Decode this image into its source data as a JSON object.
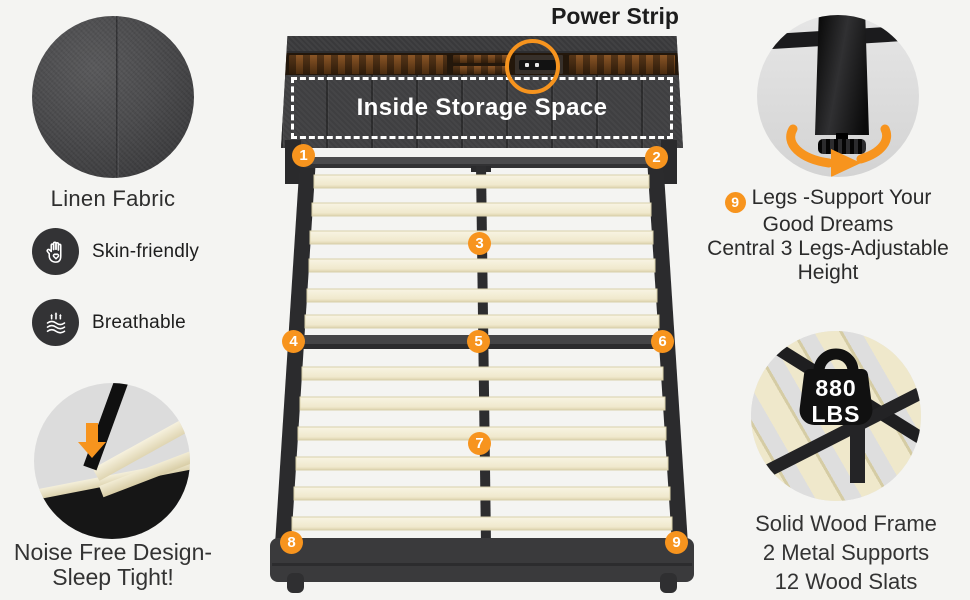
{
  "theme": {
    "accent": "#f7941e",
    "fabric_dark": "#3f3f41",
    "slat_cream": "#f3eed8",
    "background": "#f4f4f2"
  },
  "left": {
    "fabric_label": "Linen Fabric",
    "features": [
      {
        "icon": "hand-heart-icon",
        "label": "Skin-friendly"
      },
      {
        "icon": "breathable-airflow-icon",
        "label": "Breathable"
      }
    ],
    "noise_caption": {
      "line1": "Noise Free Design-",
      "line2": "Sleep Tight!"
    }
  },
  "bed": {
    "power_strip_label": "Power Strip",
    "storage_label": "Inside Storage Space",
    "badges": [
      "1",
      "2",
      "3",
      "4",
      "5",
      "6",
      "7",
      "8",
      "9"
    ]
  },
  "right": {
    "legs_note": {
      "badge": "9",
      "line1": "Legs -Support Your",
      "line2": "Good Dreams",
      "line3": "Central 3 Legs-Adjustable",
      "line4": "Height"
    },
    "weight": {
      "value": "880",
      "unit": "LBS"
    },
    "frame_note": {
      "line1": "Solid Wood Frame",
      "line2": "2 Metal Supports",
      "line3": "12 Wood Slats"
    }
  }
}
